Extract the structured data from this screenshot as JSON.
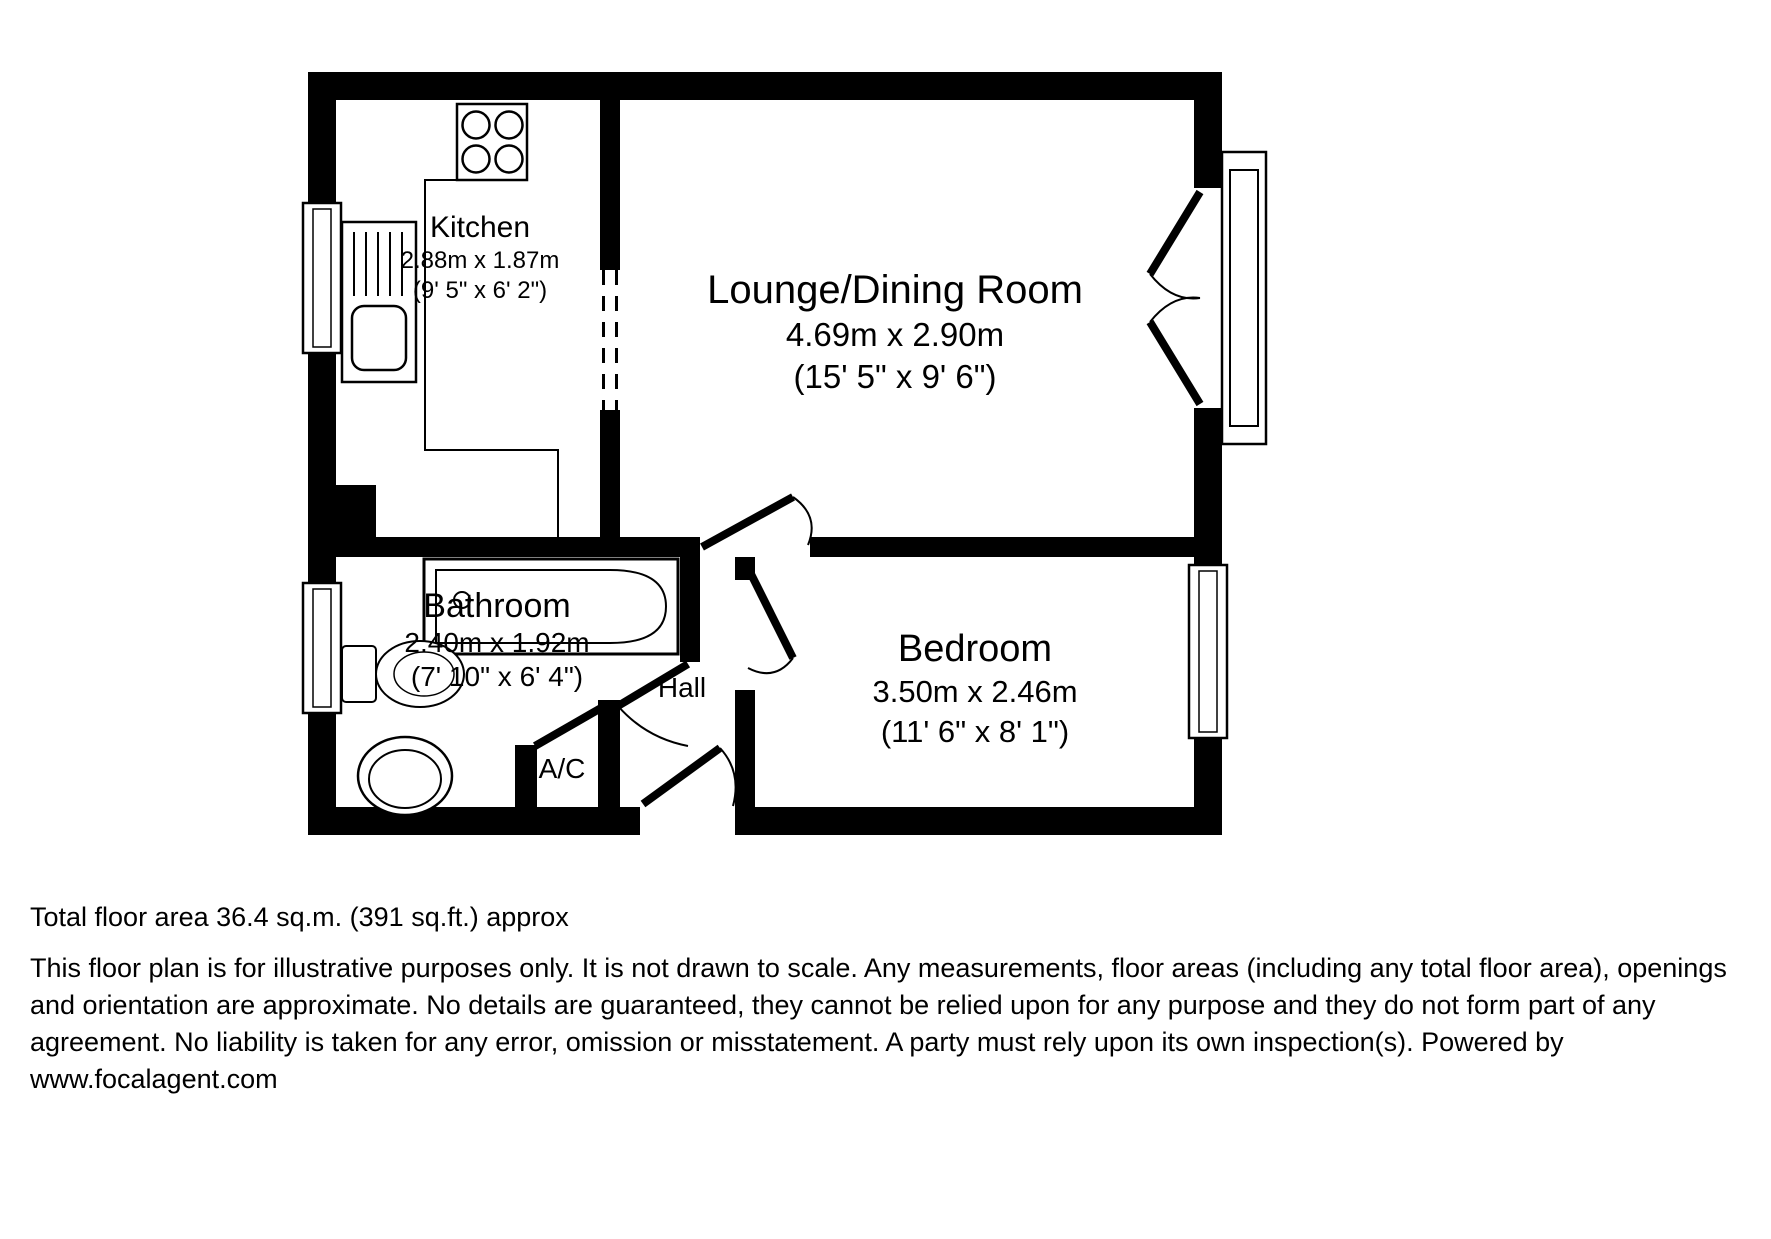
{
  "plan": {
    "rooms": {
      "kitchen": {
        "name": "Kitchen",
        "metric": "2.88m x 1.87m",
        "imperial": "(9' 5\" x 6' 2\")"
      },
      "lounge": {
        "name": "Lounge/Dining Room",
        "metric": "4.69m x 2.90m",
        "imperial": "(15' 5\" x 9' 6\")"
      },
      "bathroom": {
        "name": "Bathroom",
        "metric": "2.40m x 1.92m",
        "imperial": "(7' 10\" x 6' 4\")"
      },
      "bedroom": {
        "name": "Bedroom",
        "metric": "3.50m x 2.46m",
        "imperial": "(11' 6\" x 8' 1\")"
      },
      "hall": {
        "name": "Hall"
      },
      "airing_cupboard": {
        "name": "A/C"
      }
    },
    "colors": {
      "wall": "#000000",
      "line": "#000000",
      "background": "#ffffff"
    }
  },
  "footer": {
    "total_area": "Total floor area 36.4 sq.m. (391 sq.ft.) approx",
    "disclaimer": "This floor plan is for illustrative purposes only. It is not drawn to scale. Any measurements, floor areas (including any total floor area), openings and orientation are approximate. No details are guaranteed, they cannot be relied upon for any purpose and they do not form part of any agreement. No liability is taken for any error, omission or misstatement. A party must rely upon its own inspection(s). Powered by www.focalagent.com"
  }
}
